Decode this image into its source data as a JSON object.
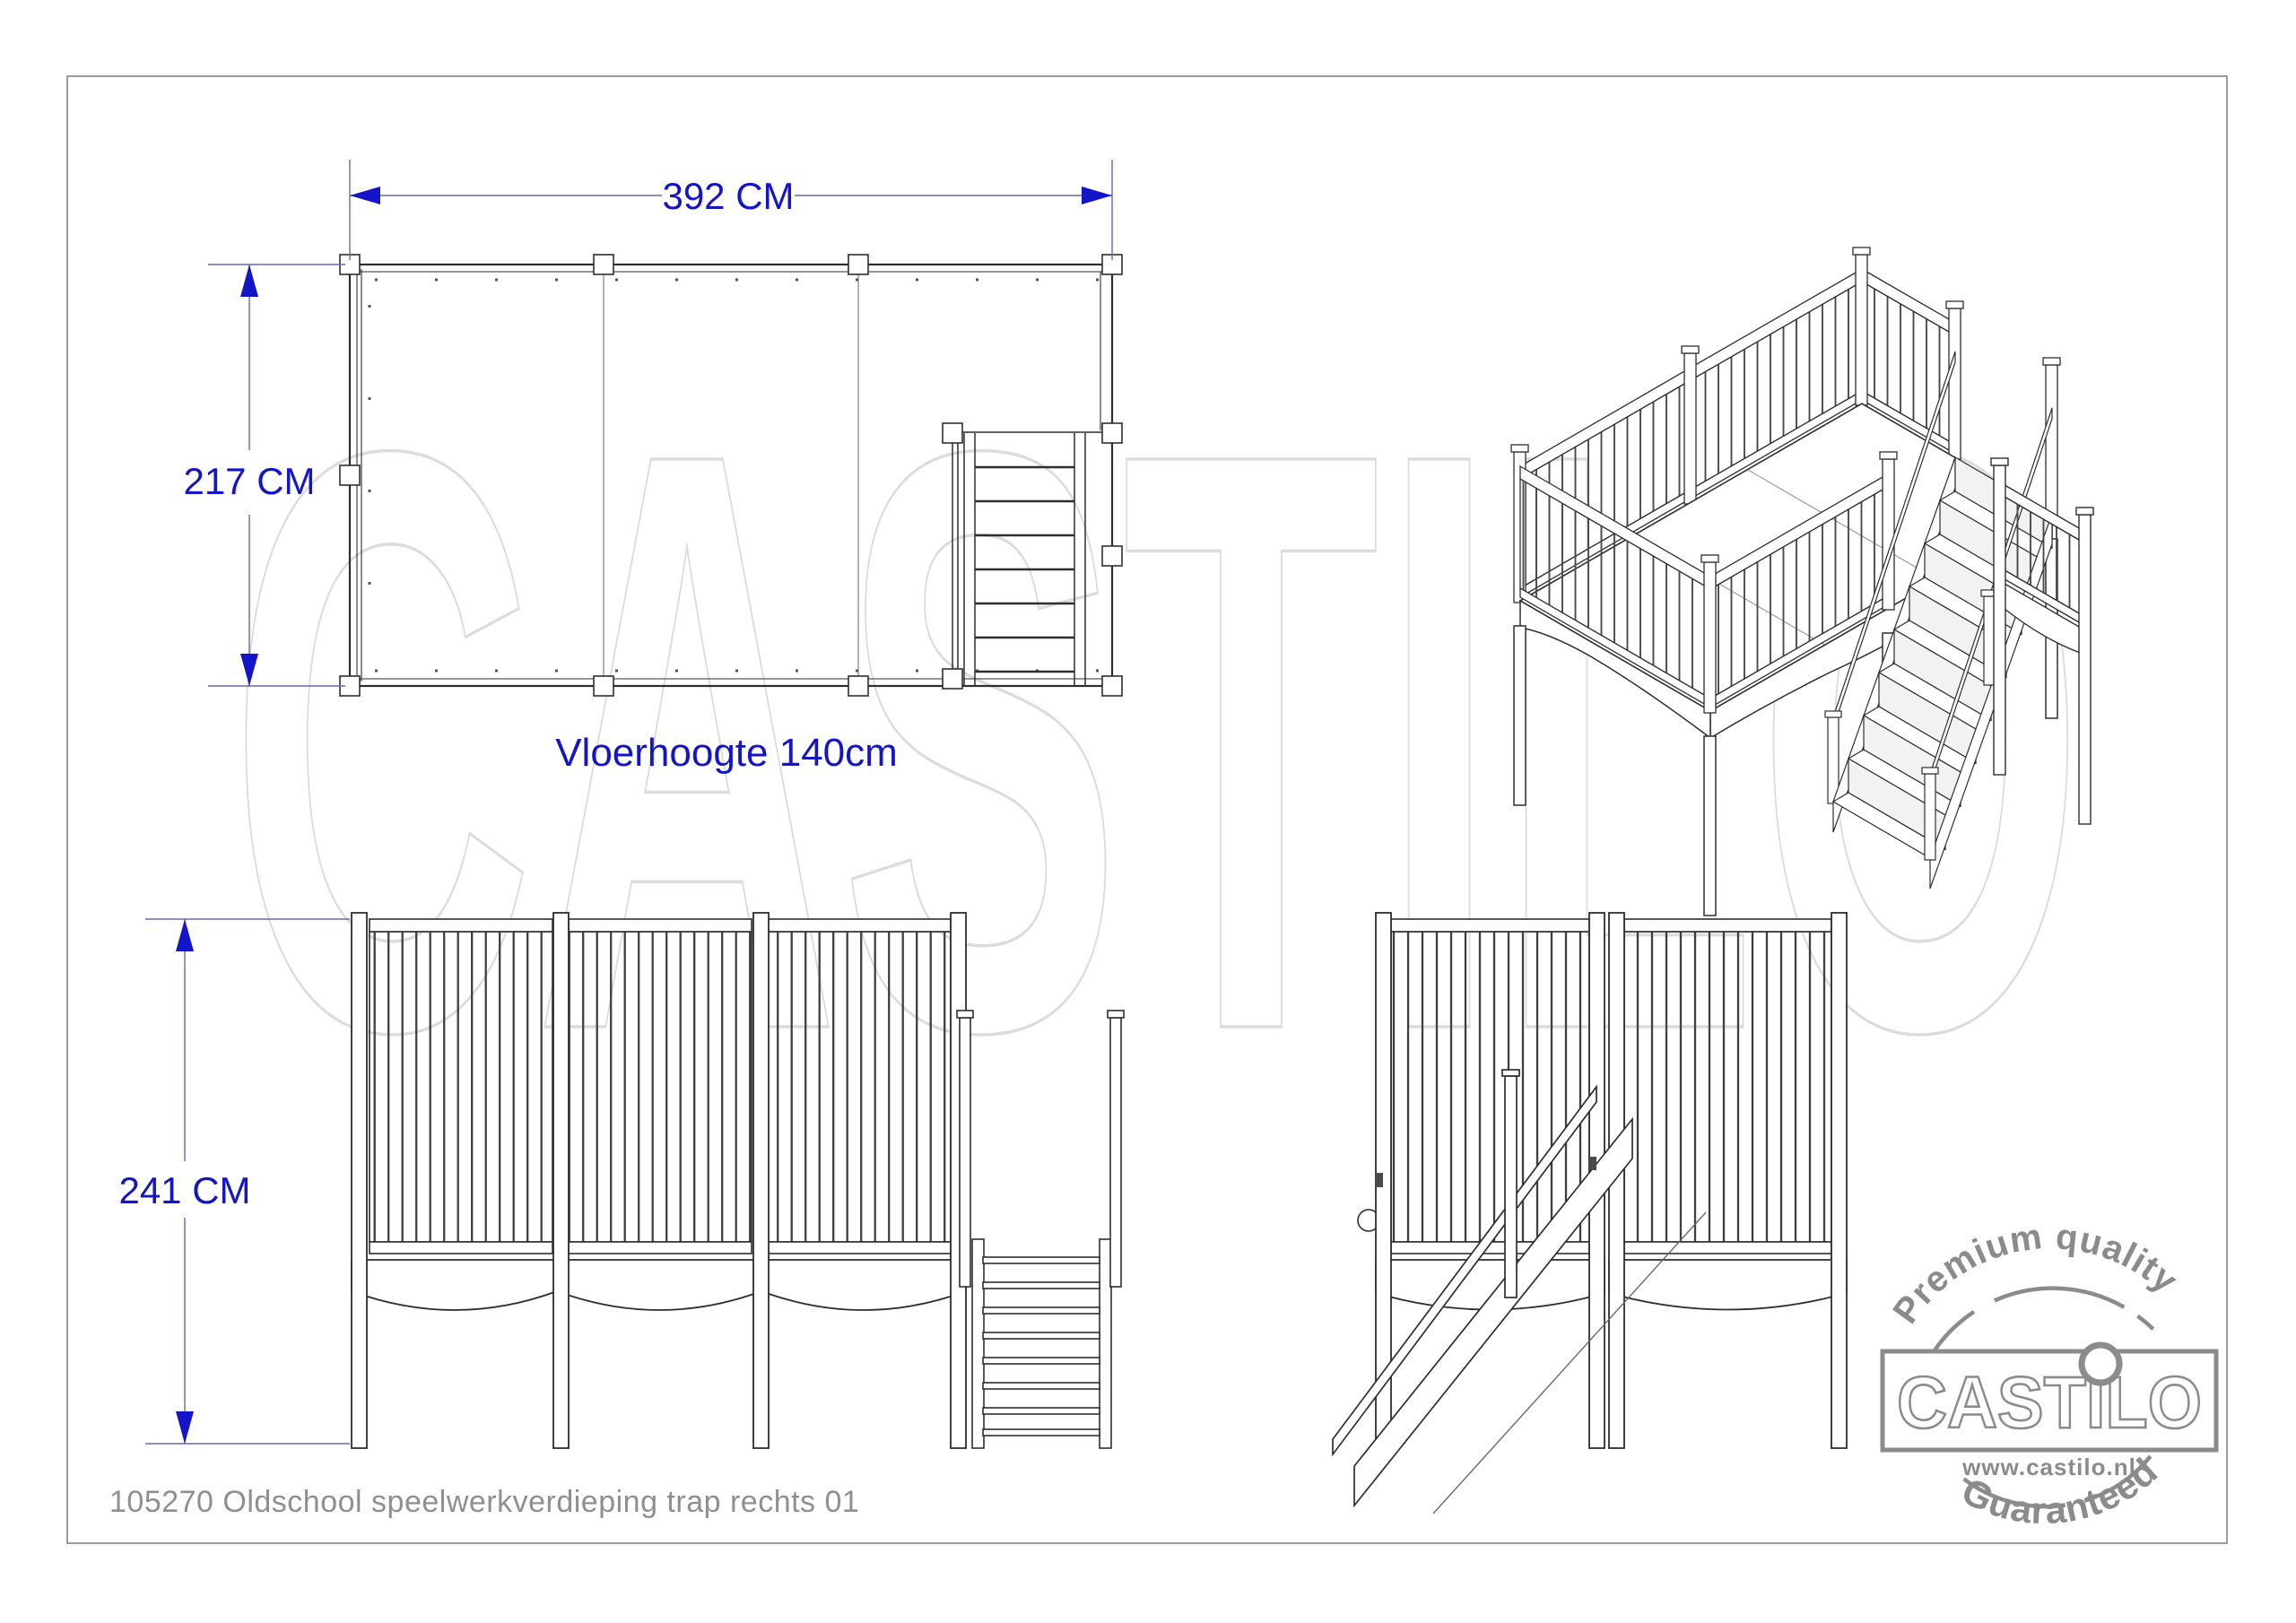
{
  "footer": {
    "drawing_title": "105270 Oldschool speelwerkverdieping trap rechts 01"
  },
  "watermark": {
    "text": "CASTILO"
  },
  "views": {
    "plan": {
      "dim_width": "392 CM",
      "dim_depth": "217 CM",
      "floor_height_label": "Vloerhoogte 140cm"
    },
    "front": {
      "dim_height": "241 CM"
    },
    "side": {},
    "iso": {}
  },
  "logo": {
    "top_arc": "Premium quality",
    "brand": "CASTILO",
    "url": "www.castilo.nl",
    "bottom_arc": "Guaranteed"
  },
  "colors": {
    "dimension_blue": "#1414c8",
    "line_black": "#2e2e2e",
    "watermark_gray": "#dcdcdc",
    "logo_gray": "#8b8b8b",
    "title_gray": "#8f8f8f"
  }
}
